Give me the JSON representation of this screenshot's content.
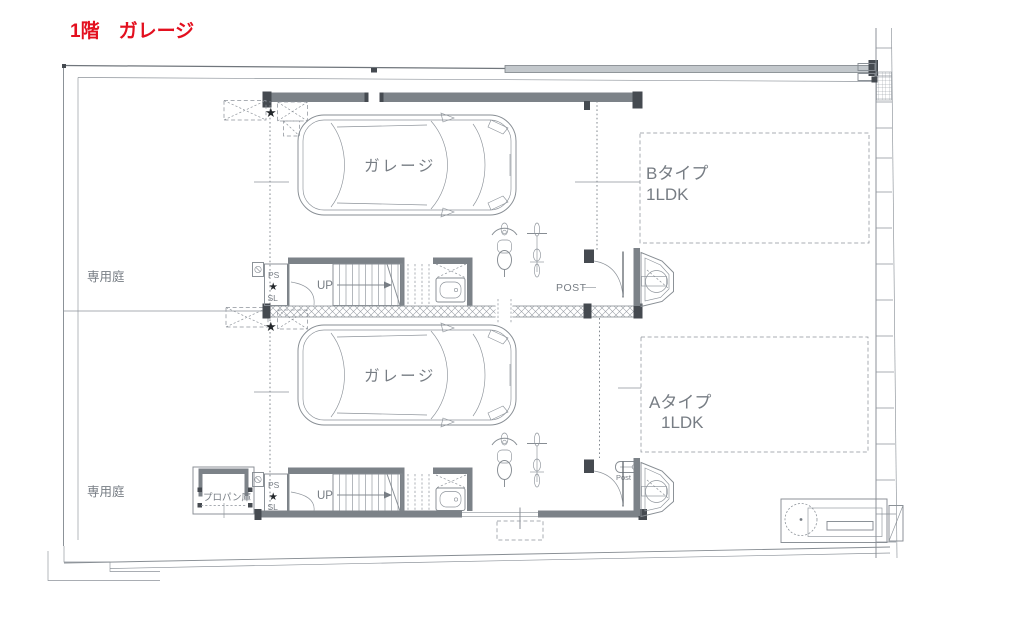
{
  "title": {
    "label": "1階　ガレージ",
    "color": "#e3101f"
  },
  "site": {
    "garden_upper": "専用庭",
    "garden_lower": "専用庭",
    "propane": "プロパン庫"
  },
  "unit_b": {
    "name": "Bタイプ",
    "layout": "1LDK",
    "garage": "ガレージ",
    "post": "POST",
    "ps": "PS",
    "sl": "SL",
    "up": "UP"
  },
  "unit_a": {
    "name": "Aタイプ",
    "layout": "1LDK",
    "garage": "ガレージ",
    "post": "Post",
    "ps": "PS",
    "sl": "SL",
    "up": "UP"
  },
  "symbols": {
    "star": "★"
  }
}
